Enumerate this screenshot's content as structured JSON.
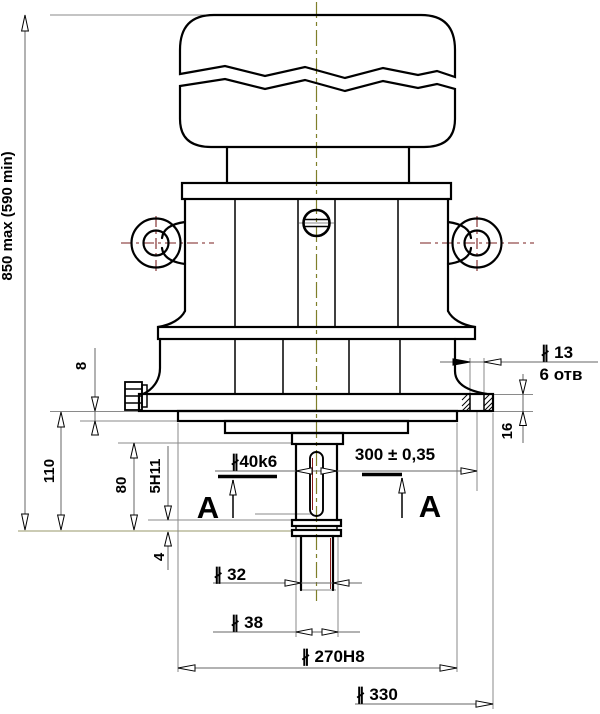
{
  "drawing": {
    "kind": "engineering-drawing",
    "language": "ru",
    "dimensions": {
      "overall_height": "850 max (590 min)",
      "spigot_protrusion": "8",
      "flange_to_shaft_end": "110",
      "boss_to_shaft_end": "80",
      "keyway_width": "5H11",
      "groove_width": "4",
      "shaft_diameter": "∦40k6",
      "bolt_circle_diameter": "300 ± 0,35",
      "hole_diameter": "∦ 13",
      "hole_count": "6 отв",
      "flange_thickness": "16",
      "shaft_end_diameter": "∦ 32",
      "collar_diameter": "∦ 38",
      "spigot_diameter": "∦ 270H8",
      "flange_outer_diameter": "∦ 330"
    },
    "section_marks": {
      "left": "A",
      "right": "A"
    },
    "colors": {
      "outline": "#000000",
      "dimension_line": "#666666",
      "extension_line": "#8a8a8a",
      "centerline_olive": "#7f7f2a",
      "centerline_red": "#7a1f1f",
      "background": "#ffffff"
    }
  }
}
